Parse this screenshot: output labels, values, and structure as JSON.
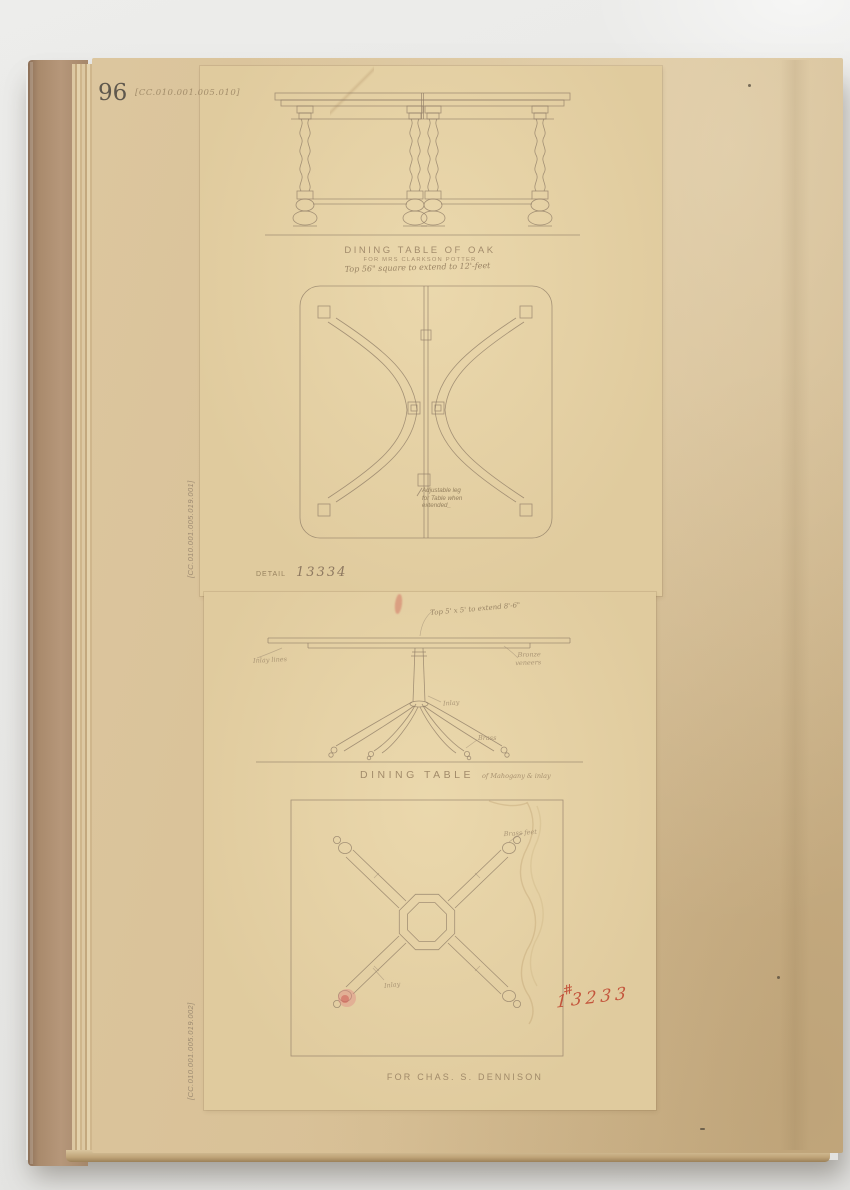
{
  "header": {
    "page_number": "96",
    "catalog_code": "[CC.010.001.005.010]"
  },
  "margin": {
    "code_upper": "[CC.010.001.005.019.001]",
    "code_lower": "[CC.010.001.005.019.002]"
  },
  "oak_table": {
    "title": "DINING TABLE OF OAK",
    "subtitle": "FOR MRS CLARKSON POTTER",
    "dimension_note": "Top 56\" square to extend to 12'-feet",
    "plan_note_lines": [
      "Adjustable leg",
      "for Table when",
      "extended_"
    ],
    "detail_label": "DETAIL",
    "detail_number": "13334"
  },
  "mahogany_table": {
    "top_note": "Top 5' x 5' to extend 8'-6\"",
    "label_inlay_lines": "Inlay lines",
    "label_bronze": "Bronze veneers",
    "label_inlay": "Inlay",
    "label_brass": "Brass",
    "title": "DINING TABLE",
    "title_material": "of Mahogany & inlay",
    "label_brass_feet": "Brass feet",
    "label_inlay_plan": "Inlay",
    "order_hash": "#",
    "order_number": "13233",
    "caption": "FOR CHAS. S. DENNISON"
  },
  "colors": {
    "backdrop": "#e8e8e6",
    "cover": "#ab8a6c",
    "page": "#d8c096",
    "tracing_sheet": "#e0cb9e",
    "pencil": "#8c7a64",
    "red_pencil": "#c0452f"
  }
}
